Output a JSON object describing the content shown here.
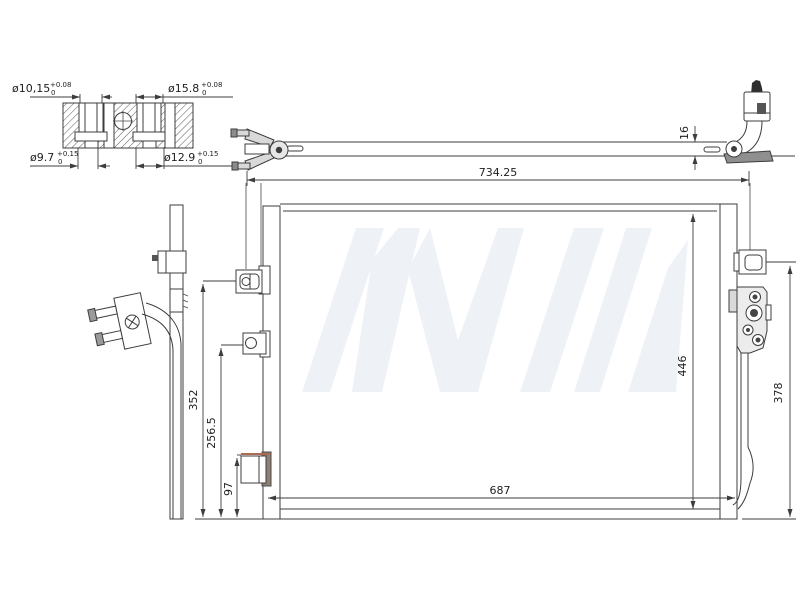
{
  "labels": {
    "bushing": {
      "d1": {
        "value": "ø10,15",
        "tol_plus": "+0.08",
        "tol_minus": "0"
      },
      "d2": {
        "value": "ø15.8",
        "tol_plus": "+0.08",
        "tol_minus": "0"
      },
      "d3": {
        "value": "ø9.7",
        "tol_plus": "+0.15",
        "tol_minus": "0"
      },
      "d4": {
        "value": "ø12.9",
        "tol_plus": "+0.15",
        "tol_minus": "0"
      }
    },
    "top_view": {
      "thickness": "16",
      "overall_width": "734.25"
    },
    "front_view": {
      "core_width": "687",
      "core_height": "446",
      "right_bracket_height": "378",
      "left_bracket1_height": "352",
      "left_bracket2_height": "256.5",
      "left_bracket3_height": "97"
    }
  },
  "colors": {
    "line": "#3d3d3d",
    "bracket_shade": "#8d8074",
    "accent_line": "#b06a52",
    "watermark": "#e3eaf1"
  }
}
